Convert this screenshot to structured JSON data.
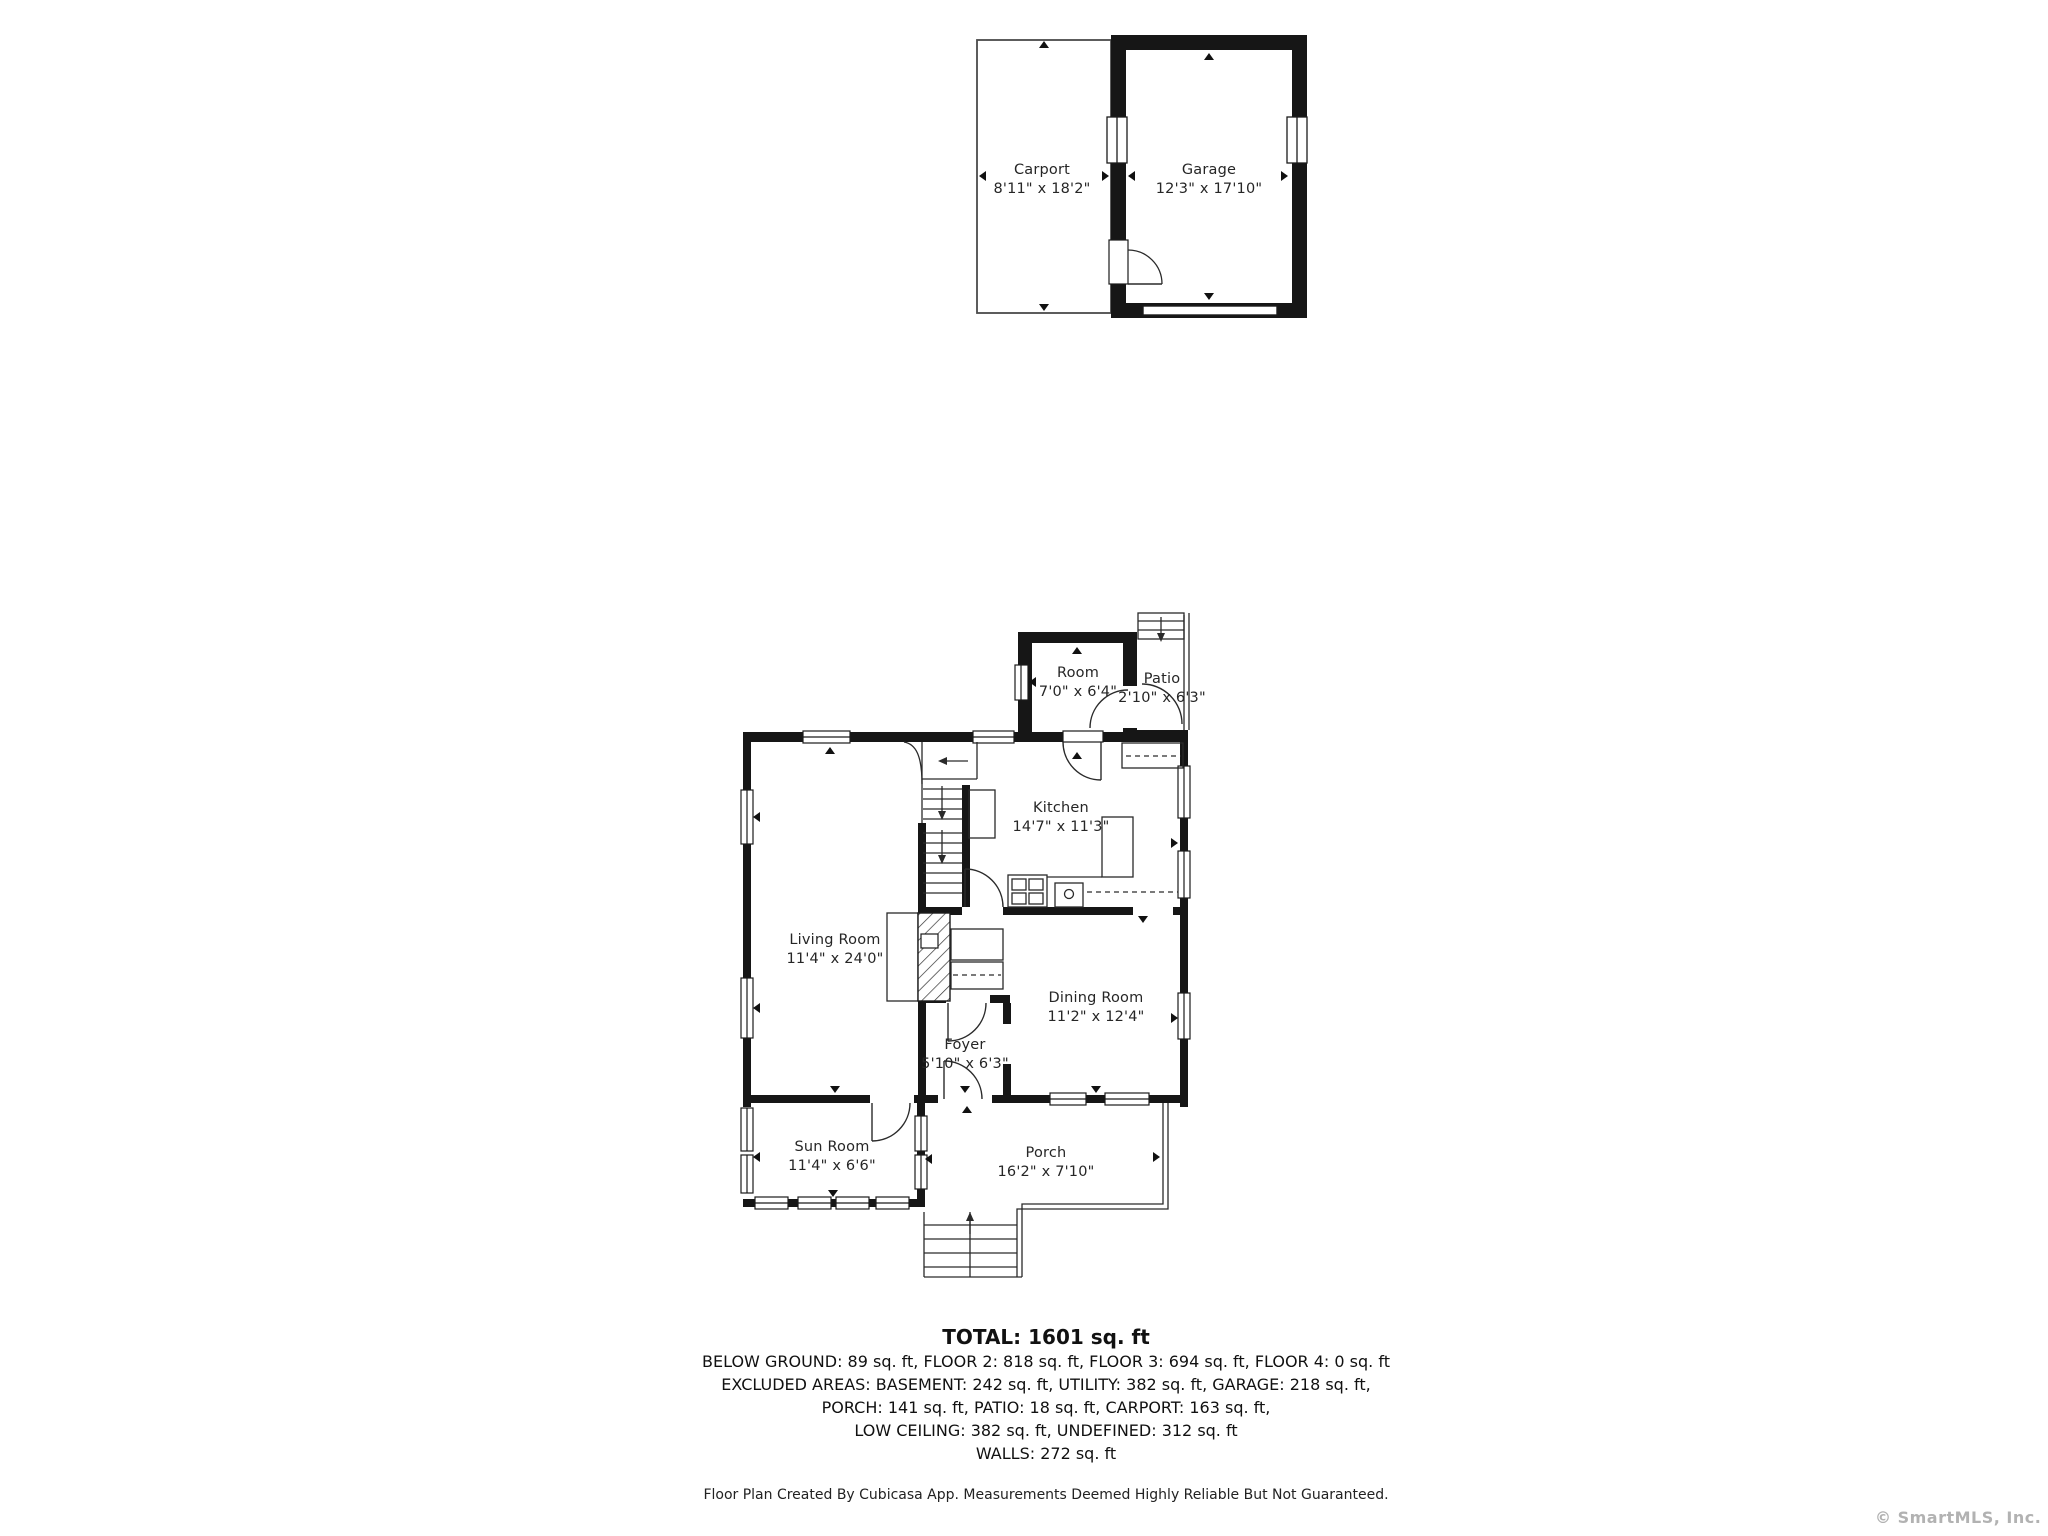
{
  "rooms": {
    "carport": {
      "name": "Carport",
      "dims": "8'11\" x 18'2\""
    },
    "garage": {
      "name": "Garage",
      "dims": "12'3\" x 17'10\""
    },
    "room": {
      "name": "Room",
      "dims": "7'0\" x 6'4\""
    },
    "patio": {
      "name": "Patio",
      "dims": "2'10\" x 6'3\""
    },
    "kitchen": {
      "name": "Kitchen",
      "dims": "14'7\" x 11'3\""
    },
    "living_room": {
      "name": "Living Room",
      "dims": "11'4\" x 24'0\""
    },
    "dining_room": {
      "name": "Dining Room",
      "dims": "11'2\" x 12'4\""
    },
    "foyer": {
      "name": "Foyer",
      "dims": "5'10\" x 6'3\""
    },
    "sun_room": {
      "name": "Sun Room",
      "dims": "11'4\" x 6'6\""
    },
    "porch": {
      "name": "Porch",
      "dims": "16'2\" x 7'10\""
    }
  },
  "summary": {
    "total": "TOTAL: 1601 sq. ft",
    "lines": [
      "BELOW GROUND: 89 sq. ft, FLOOR 2: 818 sq. ft, FLOOR 3: 694 sq. ft, FLOOR 4: 0 sq. ft",
      "EXCLUDED AREAS: BASEMENT: 242 sq. ft, UTILITY: 382 sq. ft, GARAGE: 218 sq. ft,",
      "PORCH: 141 sq. ft, PATIO: 18 sq. ft, CARPORT: 163 sq. ft,",
      "LOW CEILING: 382 sq. ft, UNDEFINED: 312 sq. ft",
      "WALLS: 272 sq. ft"
    ]
  },
  "footer": {
    "text": "Floor Plan Created By Cubicasa App. Measurements Deemed Highly Reliable But Not Guaranteed."
  },
  "watermark": {
    "text": "© SmartMLS, Inc.  2025"
  },
  "colors": {
    "wall": "#161616",
    "line": "#2a2a2a",
    "carport_outline": "#4a4a4a",
    "watermark": "#b2b2b2"
  }
}
